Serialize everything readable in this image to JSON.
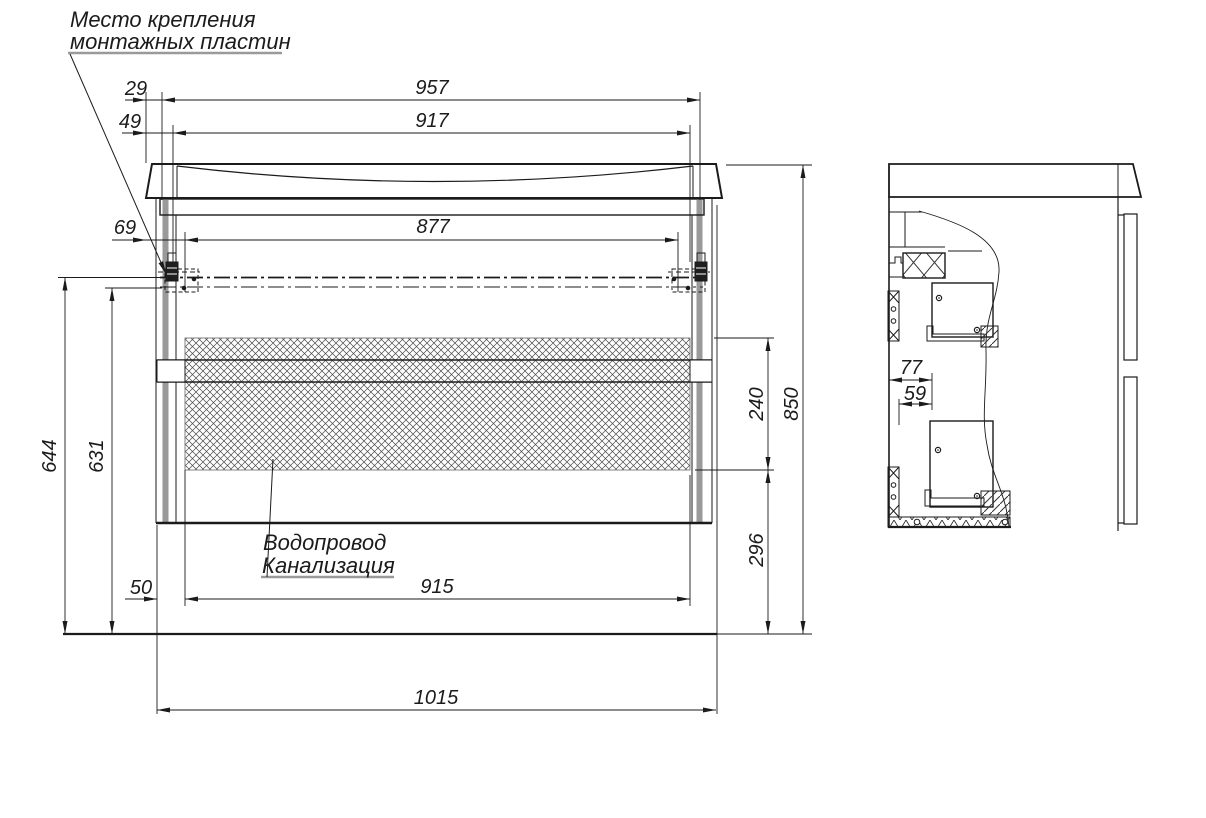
{
  "drawing": {
    "callout_mounting": {
      "line1": "Место крепления",
      "line2": "монтажных пластин"
    },
    "callout_plumbing": {
      "line1": "Водопровод",
      "line2": "Канализация"
    },
    "front": {
      "d29": "29",
      "d49": "49",
      "d69": "69",
      "d957": "957",
      "d917": "917",
      "d877": "877",
      "d644": "644",
      "d631": "631",
      "d50": "50",
      "d915": "915",
      "d1015": "1015",
      "d240": "240",
      "d296": "296",
      "d850": "850"
    },
    "side": {
      "d77": "77",
      "d59": "59"
    },
    "colors": {
      "line": "#1b1b1b",
      "panel_gray": "#9a9a9a",
      "underline_gray": "#9a9a9a",
      "hatch": "#4a4a4a"
    }
  }
}
